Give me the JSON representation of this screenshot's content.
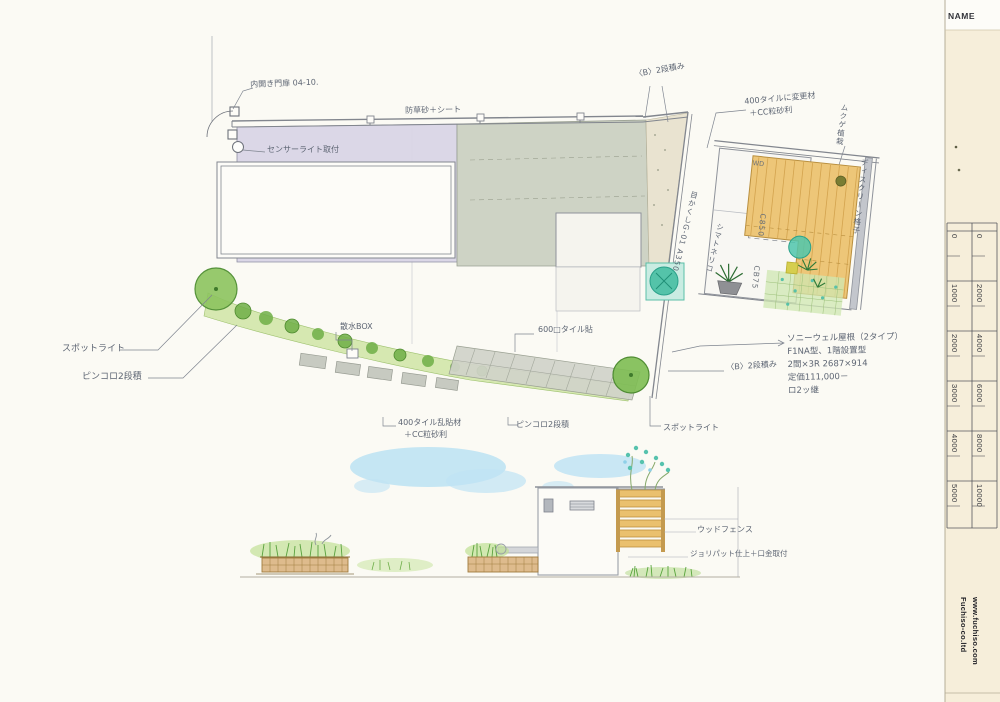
{
  "title_block": {
    "name_label": "NAME",
    "company_name": "Fuchiso-co.ltd",
    "company_url": "www.fuchiso.com"
  },
  "scale_ruler": {
    "left_scale": [
      "0",
      "1000",
      "2000",
      "3000",
      "4000",
      "5000"
    ],
    "right_scale": [
      "0",
      "2000",
      "4000",
      "6000",
      "8000",
      "10000"
    ]
  },
  "site_plan": {
    "labels": {
      "gate": "内開き門扉 04-10.",
      "sensor_light": "センサーライト取付",
      "weed_sheet": "防草砂＋シート",
      "block_2dan_top": "〈B〉2段積み",
      "spotlight_left": "スポットライト",
      "pinkoro_left": "ピンコロ2段積",
      "water_box": "散水BOX",
      "tile_600": "600□タイル貼",
      "tile_400_line1": "400タイル乱貼材",
      "tile_400_line2": "＋CC粒砂利",
      "pinkoro_bottom": "ピンコロ2段積",
      "spotlight_bottom": "スポットライト",
      "block_2dan_right": "〈B〉2段積み",
      "mekakushi_fence": "目かくしG-01 A350",
      "tree_name": "シマトネリコ"
    }
  },
  "detail_plan": {
    "labels": {
      "tile_change_line1": "400タイルに変更材",
      "tile_change_line2": "＋CC粒砂利",
      "planting": "ムクゲ植栽",
      "screen": "ディスクリーン格子",
      "wd": "WD",
      "c850": "C850",
      "cb75": "CB75"
    }
  },
  "product_note": {
    "lines": [
      "ソニーウェル屋根（2タイプ）",
      "F1NA型、1階設置型",
      "2間×3R 2687×914",
      "定価111,000－",
      "ロ2ッ継"
    ]
  },
  "elevation": {
    "labels": {
      "wood_fence": "ウッドフェンス",
      "wall_finish": "ジョリパット仕上＋口金取付"
    }
  },
  "colors": {
    "building_fill": "#d7d3e6",
    "concrete_fill": "#c9cec0",
    "deck_wood": "#edc678",
    "planting_green": "#8cc35e",
    "teal_tree": "#43bda1",
    "sky_wash": "#bfe3f3",
    "paper_strip": "#f6eeda",
    "ink": "#5d6573"
  }
}
